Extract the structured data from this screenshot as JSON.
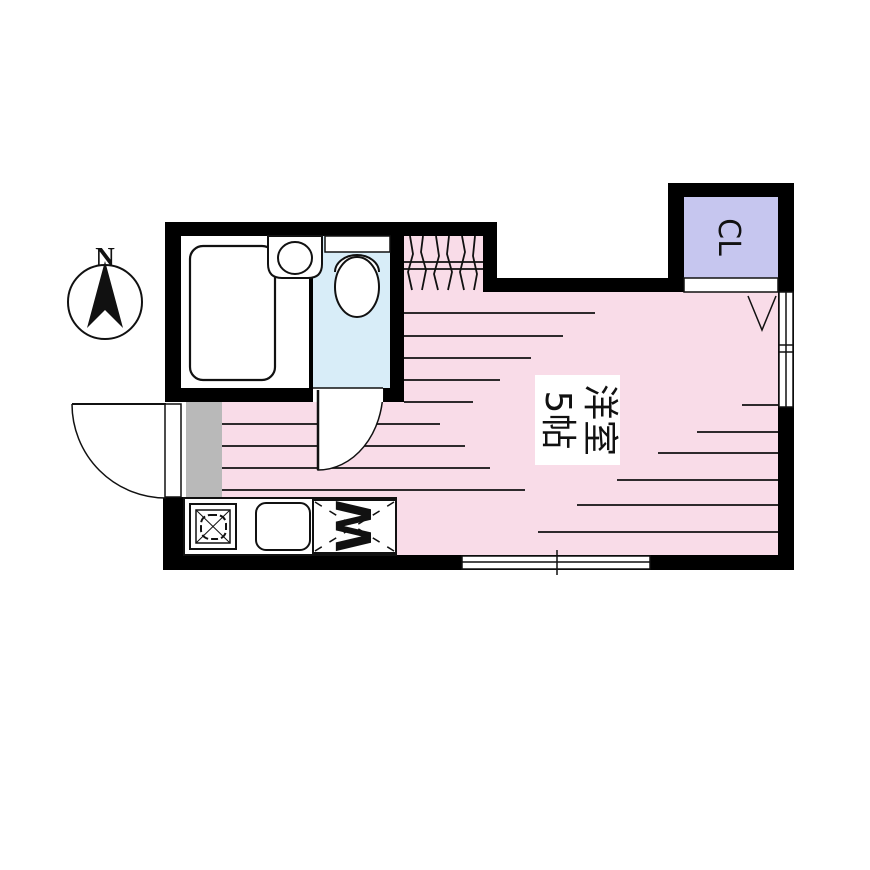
{
  "plan": {
    "compass_label": "N",
    "main_room": {
      "name_line1": "洋室",
      "name_line2": "5帖"
    },
    "closet_label": "CL",
    "washer_label": "W",
    "colors": {
      "floor_pink": "#F9DCE8",
      "floor_blue": "#D8EDF8",
      "closet_lavender": "#C6C6EF",
      "entry_gray": "#B9B9B9",
      "wall_black": "#000000",
      "bg_white": "#FFFFFF",
      "line_black": "#111111"
    }
  }
}
